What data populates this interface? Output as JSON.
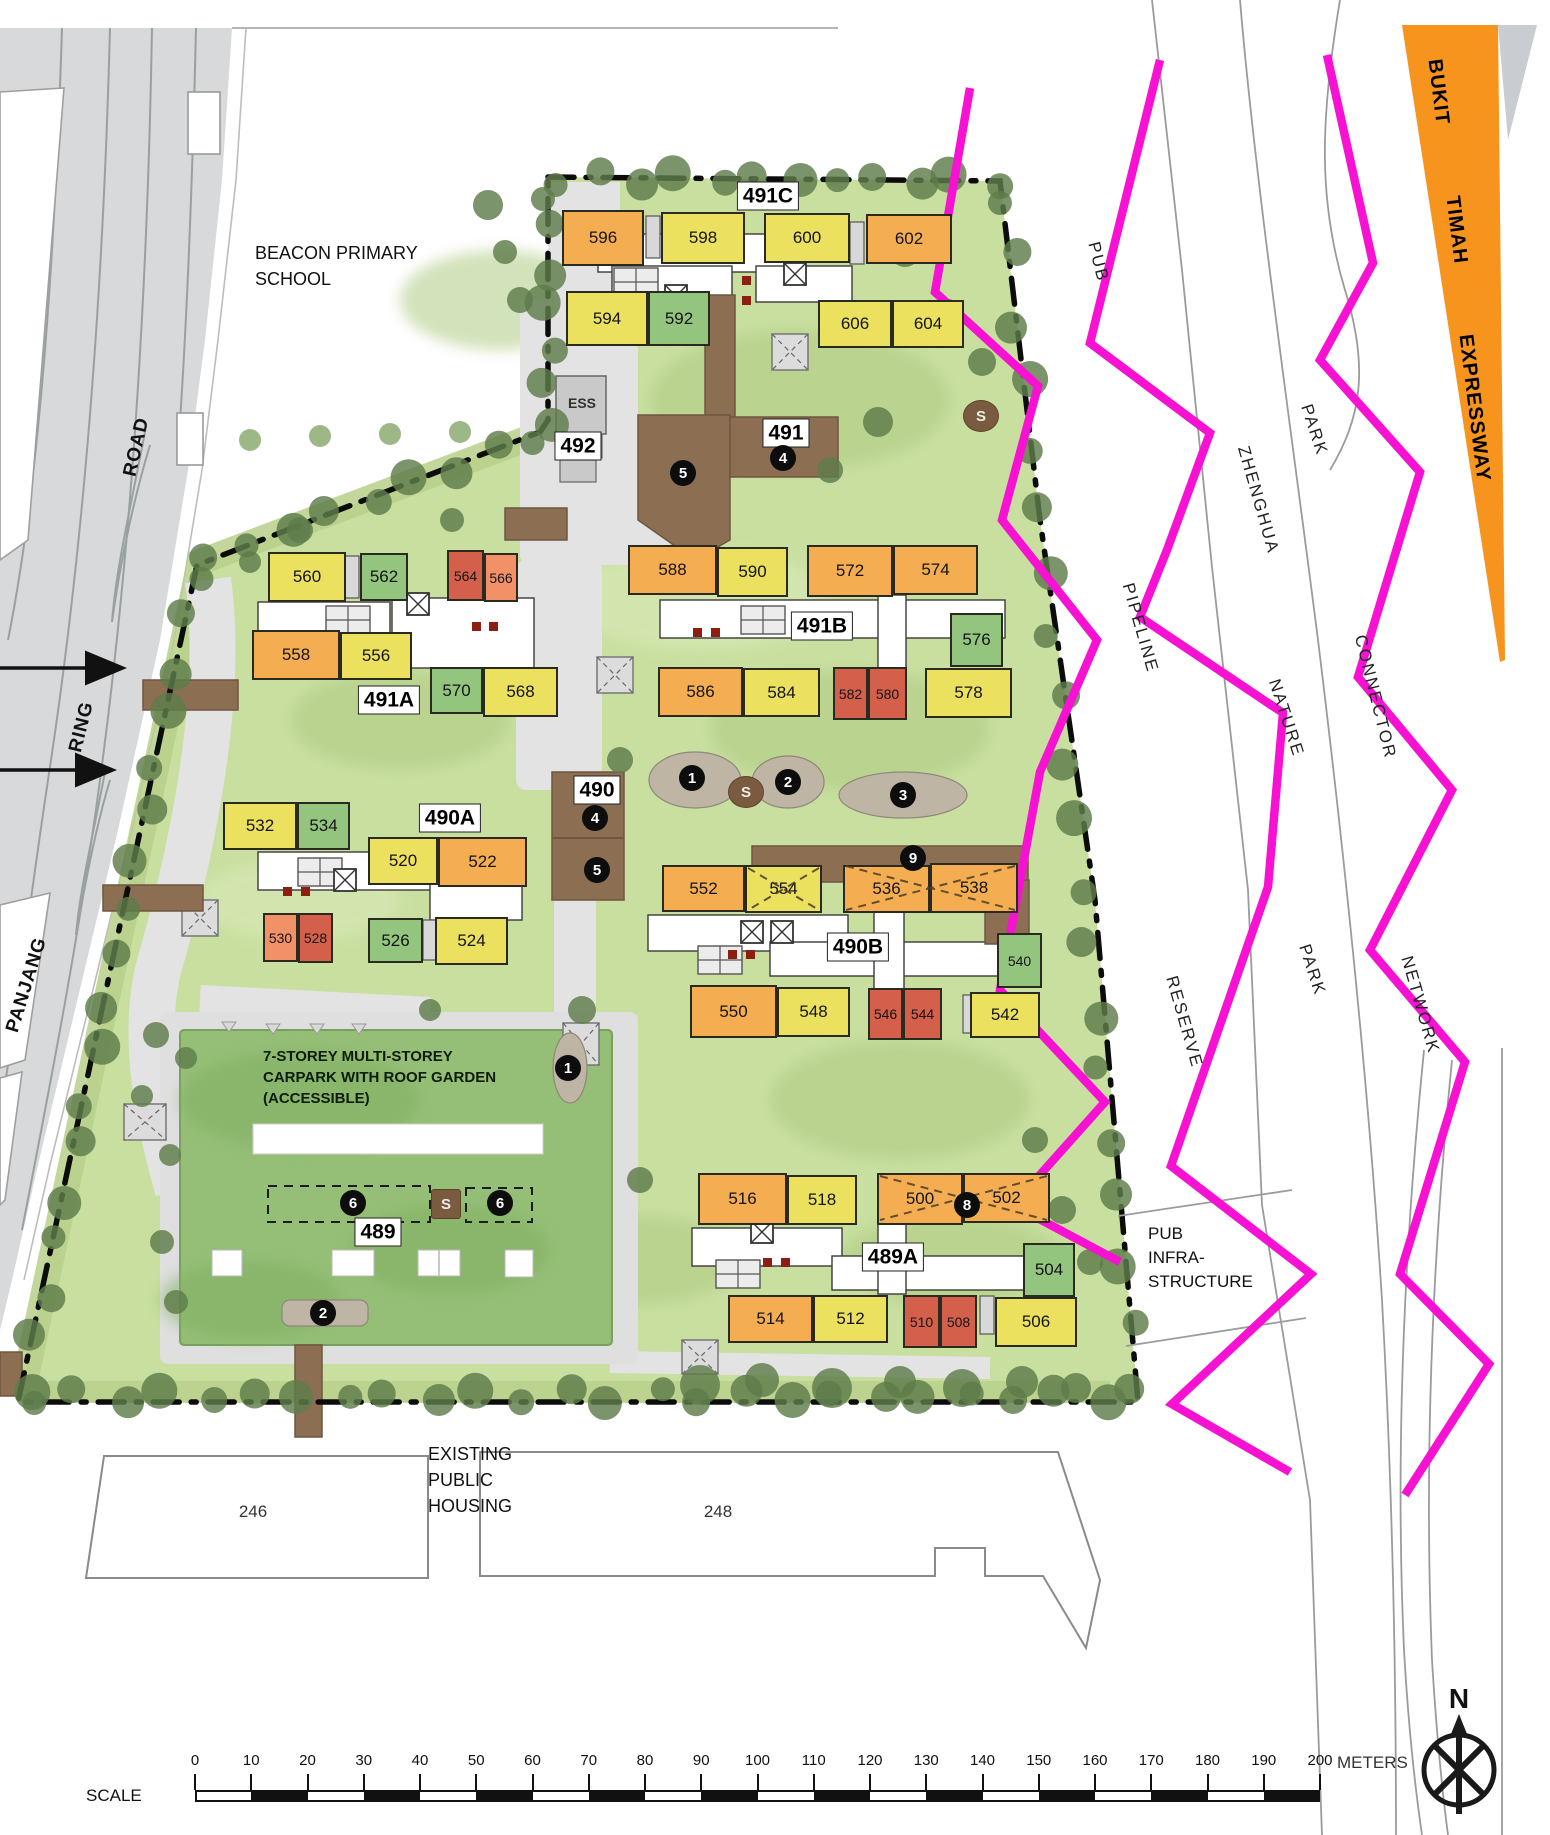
{
  "colors": {
    "yellow": "#ECE15F",
    "orange": "#F5AD51",
    "green": "#93C57F",
    "red": "#D4604C",
    "salmon": "#F29068",
    "brown": "#8C6F53",
    "magenta": "#F711D3",
    "bke_orange": "#F7941E",
    "site_green": "#C9DFA0",
    "carpark_green": "#95BF76",
    "tree": "#5E7D4B",
    "road": "#D7D9DA",
    "blob": "#BEB5A4"
  },
  "map": {
    "units": [
      {
        "label": "596",
        "c": "orange",
        "x": 562,
        "y": 210,
        "w": 82,
        "h": 56
      },
      {
        "label": "598",
        "c": "yellow",
        "x": 661,
        "y": 212,
        "w": 84,
        "h": 52
      },
      {
        "label": "600",
        "c": "yellow",
        "x": 764,
        "y": 213,
        "w": 86,
        "h": 50
      },
      {
        "label": "602",
        "c": "orange",
        "x": 866,
        "y": 214,
        "w": 86,
        "h": 50
      },
      {
        "label": "594",
        "c": "yellow",
        "x": 566,
        "y": 291,
        "w": 82,
        "h": 55
      },
      {
        "label": "592",
        "c": "green",
        "x": 648,
        "y": 291,
        "w": 62,
        "h": 55
      },
      {
        "label": "606",
        "c": "yellow",
        "x": 818,
        "y": 300,
        "w": 74,
        "h": 48
      },
      {
        "label": "604",
        "c": "yellow",
        "x": 892,
        "y": 300,
        "w": 72,
        "h": 48
      },
      {
        "label": "560",
        "c": "yellow",
        "x": 268,
        "y": 552,
        "w": 78,
        "h": 50
      },
      {
        "label": "562",
        "c": "green",
        "x": 360,
        "y": 553,
        "w": 48,
        "h": 48
      },
      {
        "label": "564",
        "c": "red",
        "x": 447,
        "y": 550,
        "w": 37,
        "h": 51
      },
      {
        "label": "566",
        "c": "salmon",
        "x": 484,
        "y": 553,
        "w": 34,
        "h": 49
      },
      {
        "label": "558",
        "c": "orange",
        "x": 252,
        "y": 630,
        "w": 88,
        "h": 50
      },
      {
        "label": "556",
        "c": "yellow",
        "x": 340,
        "y": 632,
        "w": 72,
        "h": 48
      },
      {
        "label": "570",
        "c": "green",
        "x": 430,
        "y": 667,
        "w": 53,
        "h": 47
      },
      {
        "label": "568",
        "c": "yellow",
        "x": 483,
        "y": 667,
        "w": 75,
        "h": 50
      },
      {
        "label": "588",
        "c": "orange",
        "x": 628,
        "y": 545,
        "w": 89,
        "h": 50
      },
      {
        "label": "590",
        "c": "yellow",
        "x": 717,
        "y": 547,
        "w": 71,
        "h": 50
      },
      {
        "label": "572",
        "c": "orange",
        "x": 807,
        "y": 545,
        "w": 86,
        "h": 52
      },
      {
        "label": "574",
        "c": "orange",
        "x": 893,
        "y": 545,
        "w": 85,
        "h": 50
      },
      {
        "label": "576",
        "c": "green",
        "x": 950,
        "y": 613,
        "w": 53,
        "h": 54
      },
      {
        "label": "586",
        "c": "orange",
        "x": 658,
        "y": 667,
        "w": 85,
        "h": 50
      },
      {
        "label": "584",
        "c": "yellow",
        "x": 743,
        "y": 668,
        "w": 77,
        "h": 49
      },
      {
        "label": "582",
        "c": "red",
        "x": 833,
        "y": 667,
        "w": 35,
        "h": 53
      },
      {
        "label": "580",
        "c": "red",
        "x": 868,
        "y": 667,
        "w": 39,
        "h": 53
      },
      {
        "label": "578",
        "c": "yellow",
        "x": 925,
        "y": 668,
        "w": 87,
        "h": 50
      },
      {
        "label": "532",
        "c": "yellow",
        "x": 223,
        "y": 802,
        "w": 74,
        "h": 48
      },
      {
        "label": "534",
        "c": "green",
        "x": 297,
        "y": 802,
        "w": 53,
        "h": 48
      },
      {
        "label": "520",
        "c": "yellow",
        "x": 368,
        "y": 837,
        "w": 70,
        "h": 48
      },
      {
        "label": "522",
        "c": "orange",
        "x": 438,
        "y": 837,
        "w": 89,
        "h": 50
      },
      {
        "label": "530",
        "c": "salmon",
        "x": 263,
        "y": 913,
        "w": 35,
        "h": 49
      },
      {
        "label": "528",
        "c": "red",
        "x": 298,
        "y": 913,
        "w": 35,
        "h": 50
      },
      {
        "label": "526",
        "c": "green",
        "x": 368,
        "y": 918,
        "w": 55,
        "h": 45
      },
      {
        "label": "524",
        "c": "yellow",
        "x": 435,
        "y": 917,
        "w": 73,
        "h": 48
      },
      {
        "label": "552",
        "c": "orange",
        "x": 662,
        "y": 865,
        "w": 83,
        "h": 47
      },
      {
        "label": "554",
        "c": "yellow",
        "x": 745,
        "y": 865,
        "w": 77,
        "h": 48
      },
      {
        "label": "536",
        "c": "orange",
        "x": 843,
        "y": 865,
        "w": 87,
        "h": 48
      },
      {
        "label": "538",
        "c": "orange",
        "x": 930,
        "y": 863,
        "w": 88,
        "h": 50
      },
      {
        "label": "540",
        "c": "green",
        "x": 997,
        "y": 933,
        "w": 45,
        "h": 55
      },
      {
        "label": "550",
        "c": "orange",
        "x": 690,
        "y": 985,
        "w": 87,
        "h": 53
      },
      {
        "label": "548",
        "c": "yellow",
        "x": 777,
        "y": 987,
        "w": 73,
        "h": 50
      },
      {
        "label": "546",
        "c": "red",
        "x": 868,
        "y": 988,
        "w": 35,
        "h": 52
      },
      {
        "label": "544",
        "c": "red",
        "x": 903,
        "y": 988,
        "w": 39,
        "h": 52
      },
      {
        "label": "542",
        "c": "yellow",
        "x": 970,
        "y": 992,
        "w": 70,
        "h": 46
      },
      {
        "label": "516",
        "c": "orange",
        "x": 698,
        "y": 1173,
        "w": 89,
        "h": 52
      },
      {
        "label": "518",
        "c": "yellow",
        "x": 787,
        "y": 1175,
        "w": 70,
        "h": 50
      },
      {
        "label": "500",
        "c": "orange",
        "x": 877,
        "y": 1173,
        "w": 86,
        "h": 52
      },
      {
        "label": "502",
        "c": "orange",
        "x": 963,
        "y": 1173,
        "w": 87,
        "h": 50
      },
      {
        "label": "504",
        "c": "green",
        "x": 1023,
        "y": 1243,
        "w": 52,
        "h": 54
      },
      {
        "label": "514",
        "c": "orange",
        "x": 728,
        "y": 1295,
        "w": 85,
        "h": 48
      },
      {
        "label": "512",
        "c": "yellow",
        "x": 813,
        "y": 1295,
        "w": 75,
        "h": 48
      },
      {
        "label": "510",
        "c": "red",
        "x": 903,
        "y": 1295,
        "w": 37,
        "h": 53
      },
      {
        "label": "508",
        "c": "red",
        "x": 940,
        "y": 1295,
        "w": 37,
        "h": 53
      },
      {
        "label": "506",
        "c": "yellow",
        "x": 995,
        "y": 1297,
        "w": 82,
        "h": 50
      }
    ]
  },
  "block_labels": [
    {
      "text": "491C",
      "x": 768,
      "y": 196
    },
    {
      "text": "492",
      "x": 578,
      "y": 446
    },
    {
      "text": "491",
      "x": 786,
      "y": 433
    },
    {
      "text": "491A",
      "x": 389,
      "y": 700
    },
    {
      "text": "491B",
      "x": 822,
      "y": 626
    },
    {
      "text": "490",
      "x": 597,
      "y": 790
    },
    {
      "text": "490A",
      "x": 450,
      "y": 818
    },
    {
      "text": "490B",
      "x": 858,
      "y": 947
    },
    {
      "text": "489",
      "x": 378,
      "y": 1232
    },
    {
      "text": "489A",
      "x": 893,
      "y": 1257
    }
  ],
  "markers": [
    {
      "n": "5",
      "x": 683,
      "y": 473
    },
    {
      "n": "4",
      "x": 783,
      "y": 458
    },
    {
      "n": "4",
      "x": 595,
      "y": 818
    },
    {
      "n": "5",
      "x": 597,
      "y": 870
    },
    {
      "n": "1",
      "x": 692,
      "y": 778
    },
    {
      "n": "2",
      "x": 788,
      "y": 782
    },
    {
      "n": "3",
      "x": 903,
      "y": 795
    },
    {
      "n": "9",
      "x": 913,
      "y": 858
    },
    {
      "n": "1",
      "x": 568,
      "y": 1068
    },
    {
      "n": "6",
      "x": 353,
      "y": 1203
    },
    {
      "n": "6",
      "x": 500,
      "y": 1203
    },
    {
      "n": "2",
      "x": 323,
      "y": 1313
    },
    {
      "n": "8",
      "x": 967,
      "y": 1205
    }
  ],
  "s_markers": [
    {
      "label": "S",
      "x": 981,
      "y": 416,
      "square": false
    },
    {
      "label": "S",
      "x": 746,
      "y": 792,
      "square": false
    },
    {
      "label": "S",
      "x": 446,
      "y": 1204,
      "square": true
    }
  ],
  "rotated_labels": [
    {
      "text": "ROAD",
      "x": 137,
      "y": 447,
      "rot": -77,
      "cls": "lbl-road"
    },
    {
      "text": "RING",
      "x": 82,
      "y": 727,
      "rot": -76,
      "cls": "lbl-road"
    },
    {
      "text": "PANJANG",
      "x": 27,
      "y": 985,
      "rot": -73,
      "cls": "lbl-road"
    },
    {
      "text": "PUB",
      "x": 1098,
      "y": 262,
      "rot": 76,
      "cls": "lbl-area"
    },
    {
      "text": "ZHENGHUA",
      "x": 1258,
      "y": 500,
      "rot": 74,
      "cls": "lbl-area"
    },
    {
      "text": "PARK",
      "x": 1314,
      "y": 430,
      "rot": 72,
      "cls": "lbl-area"
    },
    {
      "text": "PIPELINE",
      "x": 1140,
      "y": 628,
      "rot": 74,
      "cls": "lbl-area"
    },
    {
      "text": "NATURE",
      "x": 1286,
      "y": 718,
      "rot": 72,
      "cls": "lbl-area"
    },
    {
      "text": "CONNECTOR",
      "x": 1375,
      "y": 697,
      "rot": 76,
      "cls": "lbl-area"
    },
    {
      "text": "RESERVE",
      "x": 1184,
      "y": 1022,
      "rot": 74,
      "cls": "lbl-area"
    },
    {
      "text": "PARK",
      "x": 1312,
      "y": 970,
      "rot": 72,
      "cls": "lbl-area"
    },
    {
      "text": "NETWORK",
      "x": 1420,
      "y": 1005,
      "rot": 74,
      "cls": "lbl-area"
    },
    {
      "text": "BUKIT",
      "x": 1438,
      "y": 92,
      "rot": 83,
      "cls": "lbl-bke"
    },
    {
      "text": "TIMAH",
      "x": 1456,
      "y": 230,
      "rot": 83,
      "cls": "lbl-bke"
    },
    {
      "text": "EXPRESSWAY",
      "x": 1474,
      "y": 408,
      "rot": 83,
      "cls": "lbl-bke"
    }
  ],
  "plain_labels": [
    {
      "id": "school-label",
      "text": "BEACON PRIMARY\nSCHOOL",
      "x": 255,
      "y": 240,
      "cls": "lbl-school",
      "center": false
    },
    {
      "id": "carpark-label",
      "text": "7-STOREY MULTI-STOREY\nCARPARK WITH ROOF GARDEN\n(ACCESSIBLE)",
      "x": 263,
      "y": 1046,
      "cls": "lbl-carpark",
      "center": false
    },
    {
      "id": "existing-housing-label",
      "text": "EXISTING\nPUBLIC\nHOUSING",
      "x": 428,
      "y": 1441,
      "cls": "lbl-housing",
      "center": false
    },
    {
      "id": "pub-infrastructure-label",
      "text": "PUB\nINFRA-\nSTRUCTURE",
      "x": 1148,
      "y": 1222,
      "cls": "lbl-pub",
      "center": false
    },
    {
      "id": "housing-246",
      "text": "246",
      "x": 253,
      "y": 1512,
      "cls": "lbl-num",
      "center": true
    },
    {
      "id": "housing-248",
      "text": "248",
      "x": 718,
      "y": 1512,
      "cls": "lbl-num",
      "center": true
    },
    {
      "id": "scale-label",
      "text": "SCALE",
      "x": 86,
      "y": 1786,
      "cls": "lbl-scale",
      "center": false
    },
    {
      "id": "ess-label",
      "text": "ESS",
      "x": 582,
      "y": 403,
      "cls": "lbl-ess",
      "center": true
    },
    {
      "id": "north-label",
      "text": "N",
      "x": 1459,
      "y": 1699,
      "cls": "lbl-north",
      "center": true
    }
  ],
  "scale": {
    "ticks": [
      0,
      10,
      20,
      30,
      40,
      50,
      60,
      70,
      80,
      90,
      100,
      110,
      120,
      130,
      140,
      150,
      160,
      170,
      180,
      190,
      200
    ],
    "unit": "METERS",
    "x0": 195,
    "dx": 56.25,
    "bar_y": 1790,
    "bar_h": 12
  }
}
